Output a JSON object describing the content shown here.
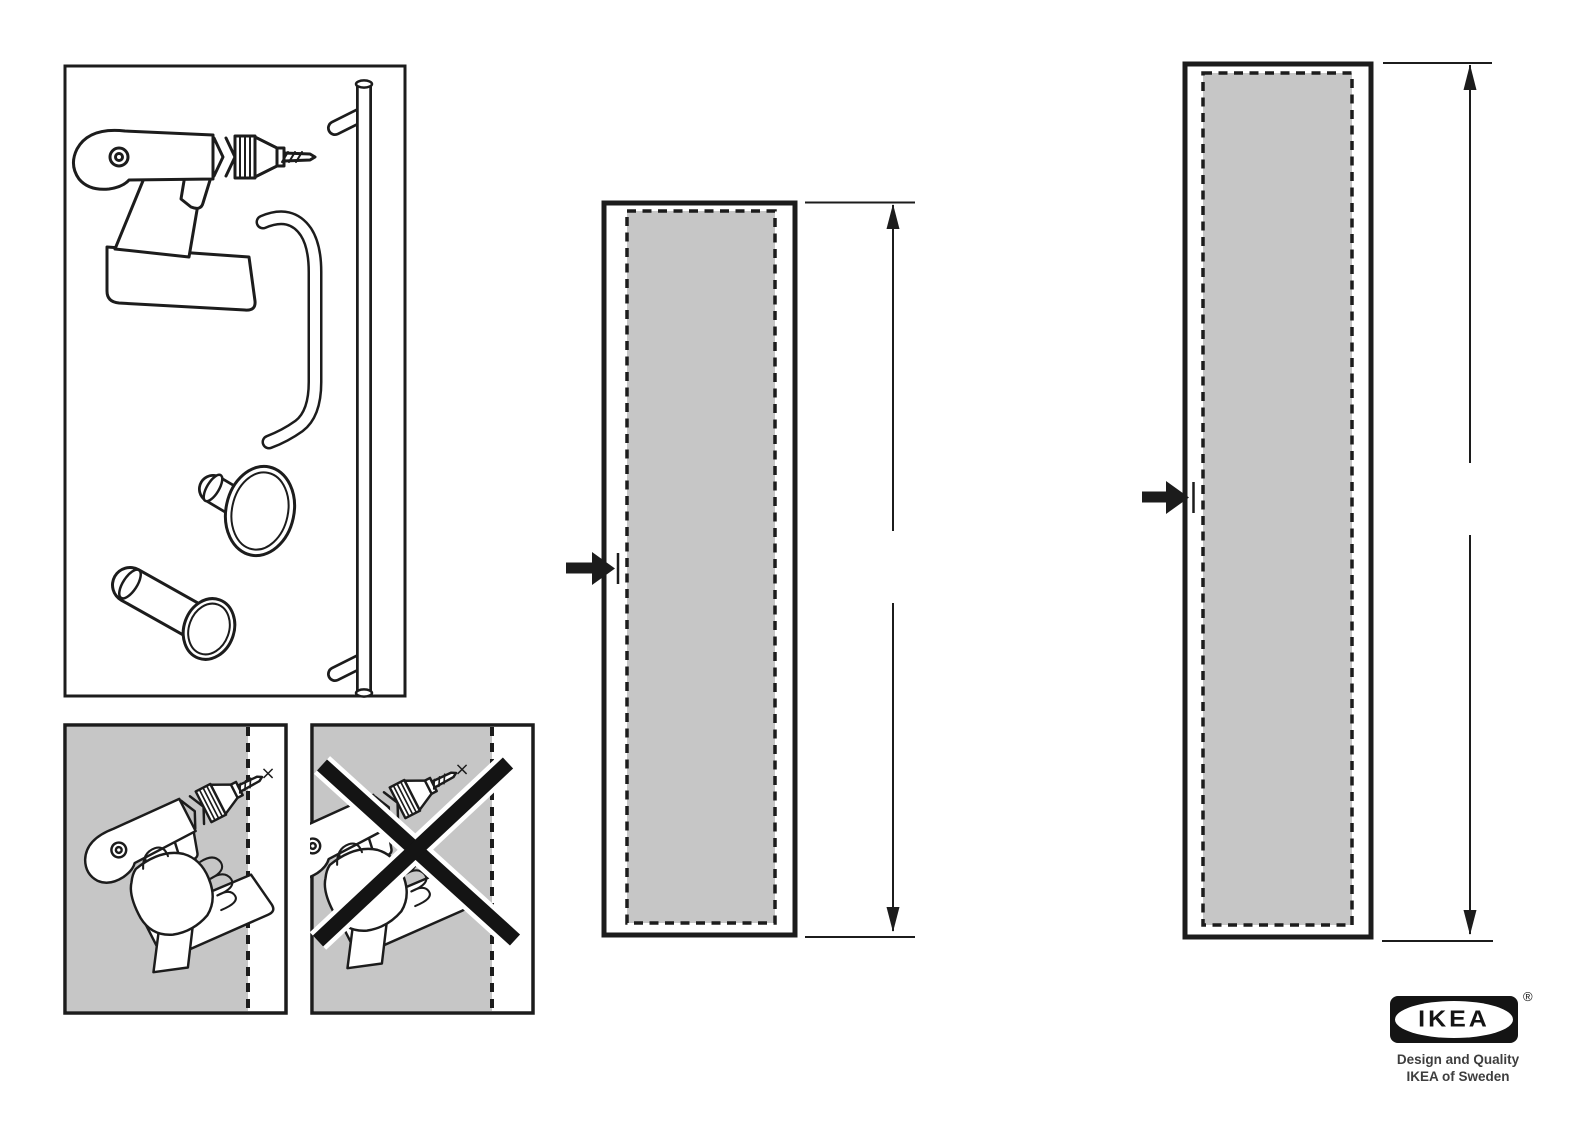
{
  "colors": {
    "ink": "#1c1c1c",
    "fill_gray": "#c6c6c6",
    "paper": "#ffffff",
    "tagline_gray": "#3e3e3e"
  },
  "tools_box": {
    "items": [
      {
        "icon": "cordless-drill-icon"
      },
      {
        "icon": "bar-handle-icon"
      },
      {
        "icon": "d-handle-icon"
      },
      {
        "icon": "round-knob-icon"
      },
      {
        "icon": "cylinder-knob-icon"
      }
    ]
  },
  "warning_panels": {
    "correct": {
      "drill_mark": "×"
    },
    "incorrect": {
      "drill_mark": "×"
    }
  },
  "door_figures": {
    "medium": {
      "arrow": "midpoint-arrow",
      "dimension": "full-height-split-at-midpoint"
    },
    "tall": {
      "arrow": "midpoint-arrow",
      "dimension": "full-height-split-at-midpoint"
    }
  },
  "logo": {
    "brand": "IKEA",
    "registered_mark": "®",
    "tagline_line1": "Design and Quality",
    "tagline_line2": "IKEA of Sweden"
  }
}
